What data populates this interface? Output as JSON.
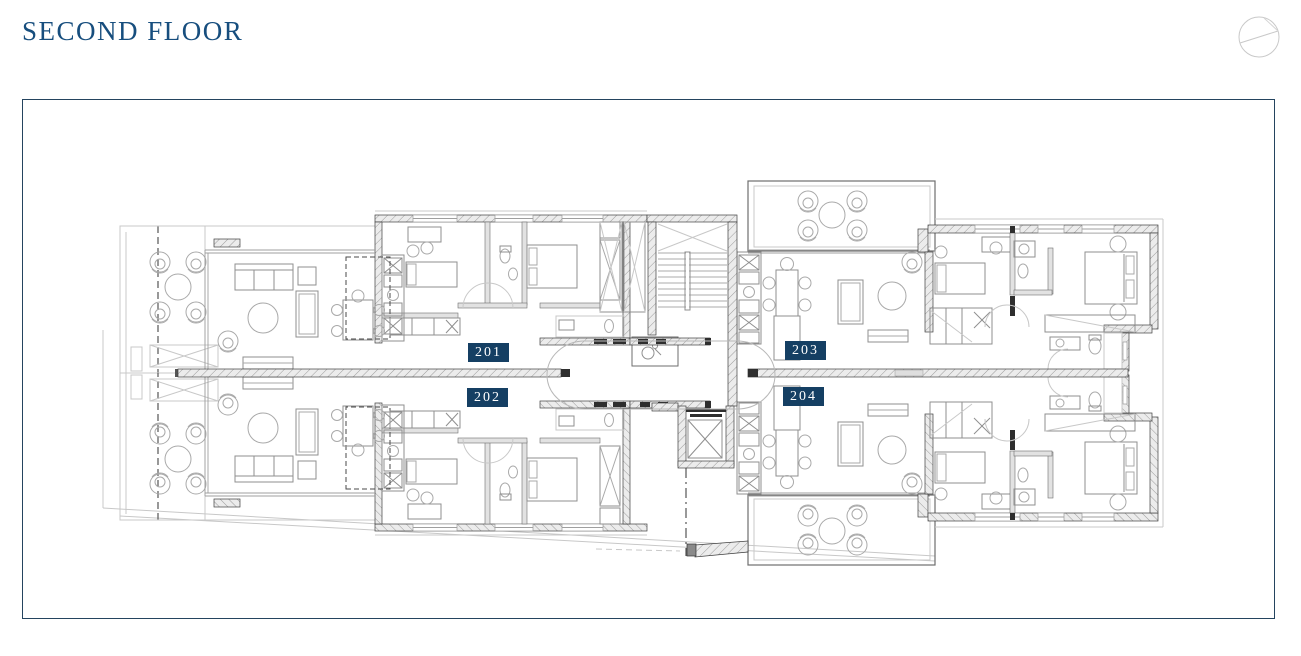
{
  "header": {
    "title": "SECOND FLOOR",
    "compass_icon": "north-indicator-icon"
  },
  "floor_plan": {
    "units": [
      {
        "number": "201",
        "position": "upper-left"
      },
      {
        "number": "202",
        "position": "lower-left"
      },
      {
        "number": "203",
        "position": "upper-right"
      },
      {
        "number": "204",
        "position": "lower-right"
      }
    ],
    "core_features": [
      "staircase",
      "elevator",
      "accessible-wc"
    ],
    "outdoor_features": [
      "left-balconies",
      "right-terraces"
    ]
  },
  "colors": {
    "title_text": "#174e7e",
    "badge_background": "#153f63",
    "badge_text": "#ffffff",
    "frame_border": "#24445f",
    "wall_line": "#3f3f3f",
    "furniture_line": "#a9a9a9"
  }
}
